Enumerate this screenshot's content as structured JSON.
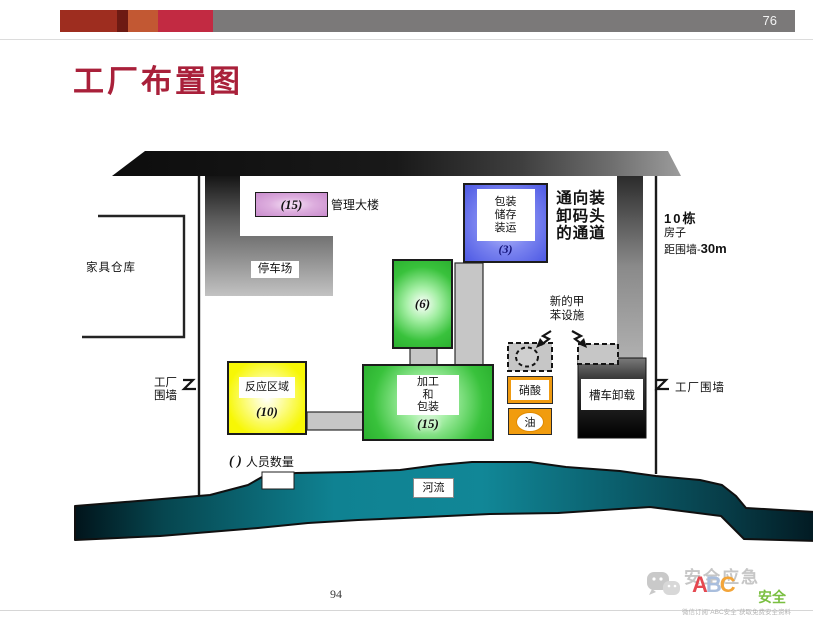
{
  "header": {
    "page_number": "76"
  },
  "title": "工厂布置图",
  "diagram": {
    "management_building": {
      "count": "(15)",
      "label": "管理大楼"
    },
    "parking": {
      "label": "停车场"
    },
    "furniture_warehouse": {
      "label": "家具仓库"
    },
    "packaging_storage": {
      "lines": [
        "包装",
        "储存",
        "装运"
      ],
      "count": "(3)"
    },
    "dock_passage": {
      "lines": [
        "通向装",
        "卸码头",
        "的通道"
      ]
    },
    "houses_note": {
      "line1": "10栋",
      "line2": "房子",
      "line3_prefix": "距围墙-",
      "line3_value": "30m"
    },
    "unit6": {
      "count": "(6)"
    },
    "processing_packaging": {
      "lines": [
        "加工",
        "和",
        "包装"
      ],
      "count": "(15)"
    },
    "reaction_area": {
      "label": "反应区域",
      "count": "(10)"
    },
    "new_toluene": {
      "lines": [
        "新的甲",
        "苯设施"
      ]
    },
    "nitric_acid": {
      "label": "硝酸"
    },
    "oil": {
      "label": "油"
    },
    "tanker_unloading": {
      "label": "槽车卸载"
    },
    "factory_wall_left": {
      "lines": [
        "工厂",
        "围墙"
      ]
    },
    "factory_wall_right": {
      "label": "工厂围墙"
    },
    "legend": {
      "symbol": "( )",
      "label": "人员数量"
    },
    "river": {
      "label": "河流"
    }
  },
  "footer": {
    "page_number": "94"
  },
  "logo": {
    "brand_gray": "安全应急",
    "letters": [
      "A",
      "B",
      "C"
    ],
    "brand_green": "安全",
    "tagline": "微信订阅\"ABC安全\"获取免费安全资料"
  },
  "colors": {
    "title": "#a9203a",
    "header_bar": "#7b7979",
    "accents": [
      "#9e2d1f",
      "#6d1a13",
      "#c25833",
      "#c22a42"
    ],
    "reaction_yellow": "#f7f705",
    "process_green": "#2cb130",
    "packaging_blue": "#4d59e4",
    "management_purple": "#c98ccd",
    "oil_orange": "#f19c0e",
    "river_teal": "#0f8292"
  }
}
